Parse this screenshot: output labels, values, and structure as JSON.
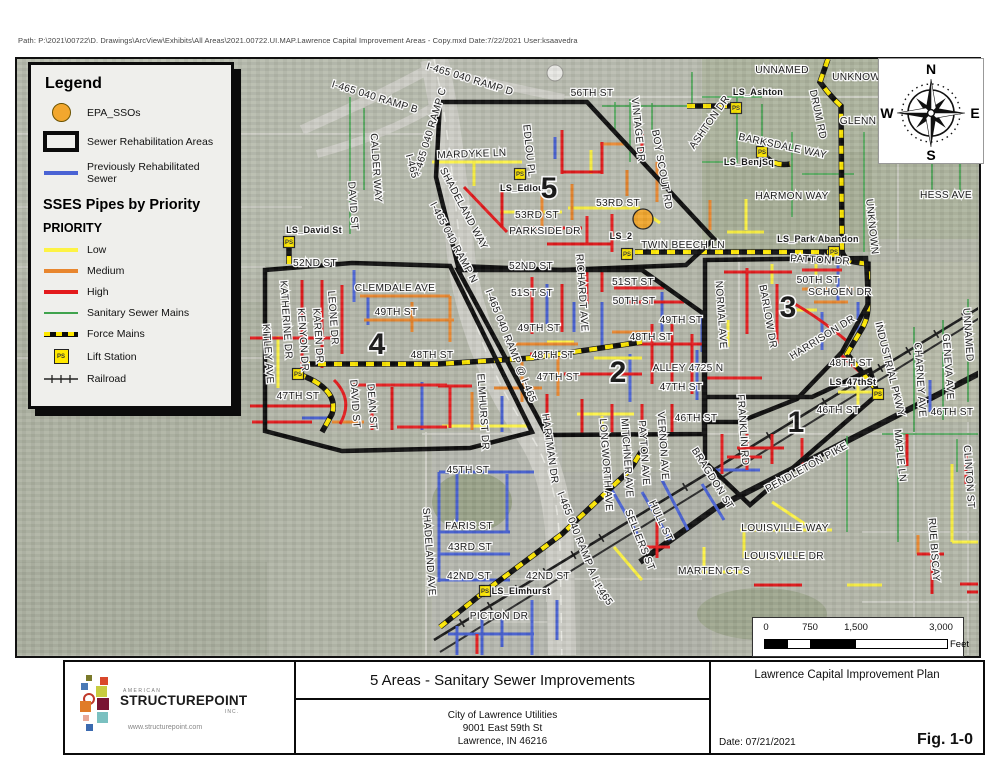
{
  "page": {
    "path_text": "Path: P:\\2021\\00722\\D. Drawings\\ArcView\\Exhibits\\All Areas\\2021.00722.UI.MAP.Lawrence Capital Improvement Areas - Copy.mxd  Date:7/22/2021  User:ksaavedra"
  },
  "colors": {
    "low": "#fdf344",
    "medium": "#e8862e",
    "high": "#e31a1c",
    "previously_rehabilitated": "#4a63d4",
    "sanitary_main": "#3fa34d",
    "sso": "#f2a72e",
    "force_main_yellow": "#ffe800"
  },
  "legend": {
    "title": "Legend",
    "top_items": [
      {
        "label": "EPA_SSOs",
        "swatch": "sso",
        "icon": "sso-circle-icon"
      },
      {
        "label": "Sewer Rehabilitation Areas",
        "swatch": "area",
        "icon": "rehab-area-icon"
      },
      {
        "label": "Previously Rehabilitated Sewer",
        "swatch": "blue",
        "icon": "blue-line-icon"
      }
    ],
    "section_title": "SSES Pipes by Priority",
    "subsection_title": "PRIORITY",
    "priority_items": [
      {
        "label": "Low",
        "swatch": "yellow",
        "icon": "yellow-line-icon"
      },
      {
        "label": "Medium",
        "swatch": "orange",
        "icon": "orange-line-icon"
      },
      {
        "label": "High",
        "swatch": "red",
        "icon": "red-line-icon"
      },
      {
        "label": "Sanitary Sewer Mains",
        "swatch": "green",
        "icon": "green-line-icon"
      },
      {
        "label": "Force Mains",
        "swatch": "force",
        "icon": "force-main-icon"
      },
      {
        "label": "Lift Station",
        "swatch": "ps",
        "ps_text": "PS",
        "icon": "lift-station-icon"
      },
      {
        "label": "Railroad",
        "swatch": "rail",
        "icon": "railroad-icon"
      }
    ]
  },
  "compass": {
    "n": "N",
    "e": "E",
    "s": "S",
    "w": "W"
  },
  "scalebar": {
    "ticks": [
      "0",
      "750",
      "1,500",
      "3,000"
    ],
    "unit": "Feet"
  },
  "titleblock": {
    "main_title": "5 Areas - Sanitary Sewer Improvements",
    "client_lines": [
      "City of Lawrence Utilities",
      "9001 East 59th St",
      "Lawrence, IN 46216"
    ],
    "plan_title": "Lawrence Capital Improvement Plan",
    "date": "Date: 07/21/2021",
    "figure": "Fig. 1-0",
    "logo": {
      "american": "AMERICAN",
      "name": "STRUCTUREPOINT",
      "inc": "INC.",
      "url": "www.structurepoint.com",
      "squares": [
        {
          "x": 21,
          "y": 13,
          "s": 6,
          "c": "#7a7a2a"
        },
        {
          "x": 35,
          "y": 15,
          "s": 8,
          "c": "#d9472b"
        },
        {
          "x": 16,
          "y": 21,
          "s": 7,
          "c": "#4a7ab5"
        },
        {
          "x": 31,
          "y": 24,
          "s": 11,
          "c": "#c8cc3f"
        },
        {
          "x": 18,
          "y": 31,
          "s": 8,
          "c": "ring"
        },
        {
          "x": 32,
          "y": 36,
          "s": 12,
          "c": "#7a1433"
        },
        {
          "x": 15,
          "y": 39,
          "s": 11,
          "c": "#e07b28"
        },
        {
          "x": 32,
          "y": 50,
          "s": 11,
          "c": "#7ac0c0"
        },
        {
          "x": 18,
          "y": 53,
          "s": 6,
          "c": "#e8a898"
        },
        {
          "x": 21,
          "y": 62,
          "s": 7,
          "c": "#3b6ab0"
        }
      ]
    }
  },
  "map": {
    "sso_points": [
      {
        "x": 641,
        "y": 217
      }
    ],
    "lift_stations": [
      {
        "x": 287,
        "y": 240
      },
      {
        "x": 296,
        "y": 372
      },
      {
        "x": 518,
        "y": 172
      },
      {
        "x": 625,
        "y": 252
      },
      {
        "x": 734,
        "y": 106
      },
      {
        "x": 760,
        "y": 150
      },
      {
        "x": 832,
        "y": 250
      },
      {
        "x": 876,
        "y": 392
      },
      {
        "x": 483,
        "y": 589
      }
    ],
    "labels": [
      {
        "t": "I-465 040 RAMP B",
        "x": 372,
        "y": 98,
        "r": 17
      },
      {
        "t": "I-465 040 RAMP C",
        "x": 431,
        "y": 130,
        "r": -73
      },
      {
        "t": "I-465 040 RAMP D",
        "x": 467,
        "y": 80,
        "r": 17
      },
      {
        "t": "56TH ST",
        "x": 590,
        "y": 94,
        "r": 0
      },
      {
        "t": "UNNAMED",
        "x": 780,
        "y": 71,
        "r": 0
      },
      {
        "t": "UNKNOWN",
        "x": 858,
        "y": 78,
        "r": 0
      },
      {
        "t": "LS_Ashton",
        "x": 756,
        "y": 93,
        "r": 0,
        "c": "ls"
      },
      {
        "t": "ASHTON DR",
        "x": 710,
        "y": 122,
        "r": -55
      },
      {
        "t": "DRUM RD",
        "x": 813,
        "y": 113,
        "r": 78
      },
      {
        "t": "GLENN",
        "x": 856,
        "y": 122,
        "r": 0
      },
      {
        "t": "BARKSDALE WAY",
        "x": 780,
        "y": 147,
        "r": 12
      },
      {
        "t": "LS_BenjSq",
        "x": 747,
        "y": 163,
        "r": 0,
        "c": "ls"
      },
      {
        "t": "HARMON WAY",
        "x": 790,
        "y": 197,
        "r": 0
      },
      {
        "t": "HESS AVE",
        "x": 944,
        "y": 196,
        "r": 0
      },
      {
        "t": "UNKNOWN",
        "x": 867,
        "y": 225,
        "r": 84
      },
      {
        "t": "LS_Park Abandon",
        "x": 816,
        "y": 240,
        "r": 0,
        "c": "ls"
      },
      {
        "t": "MARDYKE LN",
        "x": 470,
        "y": 155,
        "r": -2
      },
      {
        "t": "EDLOU PL",
        "x": 524,
        "y": 149,
        "r": 84
      },
      {
        "t": "LS_Edlou",
        "x": 520,
        "y": 189,
        "r": 0,
        "c": "ls"
      },
      {
        "t": "5",
        "x": 547,
        "y": 196,
        "r": 0,
        "c": "area"
      },
      {
        "t": "53RD ST",
        "x": 616,
        "y": 204,
        "r": 0
      },
      {
        "t": "53RD ST",
        "x": 535,
        "y": 216,
        "r": 0
      },
      {
        "t": "PARKSIDE DR",
        "x": 543,
        "y": 232,
        "r": 0
      },
      {
        "t": "LS_2",
        "x": 619,
        "y": 237,
        "r": 0,
        "c": "ls"
      },
      {
        "t": "TWIN BEECH LN",
        "x": 681,
        "y": 246,
        "r": 0
      },
      {
        "t": "VINTAGE DR",
        "x": 633,
        "y": 128,
        "r": 84
      },
      {
        "t": "BOY SCOUT RD",
        "x": 657,
        "y": 168,
        "r": 80
      },
      {
        "t": "CALDER WAY",
        "x": 371,
        "y": 166,
        "r": 86
      },
      {
        "t": "DAVID ST",
        "x": 348,
        "y": 204,
        "r": 86
      },
      {
        "t": "LS_David St",
        "x": 312,
        "y": 231,
        "r": 0,
        "c": "ls"
      },
      {
        "t": "52ND ST",
        "x": 313,
        "y": 264,
        "r": 0
      },
      {
        "t": "52ND ST",
        "x": 529,
        "y": 267,
        "r": 0
      },
      {
        "t": "SHADELAND WAY",
        "x": 459,
        "y": 208,
        "r": 62
      },
      {
        "t": "I-465",
        "x": 407,
        "y": 165,
        "r": 75
      },
      {
        "t": "I-465 040 RAMP N",
        "x": 449,
        "y": 242,
        "r": 62
      },
      {
        "t": "I-465 040 RAMP @ I-465",
        "x": 506,
        "y": 345,
        "r": 68
      },
      {
        "t": "I-465 040 RAMP A  I-465",
        "x": 577,
        "y": 545,
        "r": 68
      },
      {
        "t": "I-465",
        "x": 599,
        "y": 594,
        "r": 55
      },
      {
        "t": "CLEMDALE AVE",
        "x": 393,
        "y": 289,
        "r": 0
      },
      {
        "t": "49TH ST",
        "x": 394,
        "y": 313,
        "r": 0
      },
      {
        "t": "KITLEY AVE",
        "x": 263,
        "y": 352,
        "r": 86
      },
      {
        "t": "KATHERINE DR",
        "x": 281,
        "y": 318,
        "r": 86
      },
      {
        "t": "KENYON DR",
        "x": 298,
        "y": 338,
        "r": 86
      },
      {
        "t": "KAREN DR",
        "x": 313,
        "y": 334,
        "r": 86
      },
      {
        "t": "LEONE DR",
        "x": 328,
        "y": 316,
        "r": 86
      },
      {
        "t": "4",
        "x": 375,
        "y": 352,
        "r": 0,
        "c": "area"
      },
      {
        "t": "48TH ST",
        "x": 430,
        "y": 356,
        "r": 0
      },
      {
        "t": "48TH ST",
        "x": 551,
        "y": 356,
        "r": 0
      },
      {
        "t": "48TH ST",
        "x": 649,
        "y": 338,
        "r": 0
      },
      {
        "t": "48TH ST",
        "x": 849,
        "y": 364,
        "r": 0
      },
      {
        "t": "47TH ST",
        "x": 296,
        "y": 397,
        "r": 0
      },
      {
        "t": "47TH ST",
        "x": 556,
        "y": 378,
        "r": 0
      },
      {
        "t": "47TH ST",
        "x": 679,
        "y": 388,
        "r": 0
      },
      {
        "t": "ALLEY 4725 N",
        "x": 686,
        "y": 369,
        "r": 0
      },
      {
        "t": "DAVID ST",
        "x": 350,
        "y": 402,
        "r": 86
      },
      {
        "t": "DEAN ST",
        "x": 367,
        "y": 405,
        "r": 86
      },
      {
        "t": "2",
        "x": 616,
        "y": 380,
        "r": 0,
        "c": "area"
      },
      {
        "t": "51ST ST",
        "x": 530,
        "y": 294,
        "r": 0
      },
      {
        "t": "51ST ST",
        "x": 631,
        "y": 283,
        "r": 0
      },
      {
        "t": "50TH ST",
        "x": 632,
        "y": 302,
        "r": 0
      },
      {
        "t": "49TH ST",
        "x": 537,
        "y": 329,
        "r": 0
      },
      {
        "t": "49TH ST",
        "x": 679,
        "y": 321,
        "r": 0
      },
      {
        "t": "RICHARDT AVE",
        "x": 577,
        "y": 291,
        "r": 86
      },
      {
        "t": "PATTON DR",
        "x": 818,
        "y": 261,
        "r": 3
      },
      {
        "t": "50TH ST",
        "x": 816,
        "y": 281,
        "r": 0
      },
      {
        "t": "SCHOEN DR",
        "x": 838,
        "y": 293,
        "r": 0
      },
      {
        "t": "NORMAL AVE",
        "x": 716,
        "y": 313,
        "r": 86
      },
      {
        "t": "BARLOW DR",
        "x": 763,
        "y": 315,
        "r": 80
      },
      {
        "t": "3",
        "x": 786,
        "y": 315,
        "r": 0,
        "c": "area"
      },
      {
        "t": "HARRISON DR",
        "x": 822,
        "y": 338,
        "r": -32
      },
      {
        "t": "LS_47thSt",
        "x": 851,
        "y": 383,
        "r": 0,
        "c": "ls"
      },
      {
        "t": "1",
        "x": 794,
        "y": 430,
        "r": 0,
        "c": "area"
      },
      {
        "t": "FRANKLIN RD",
        "x": 738,
        "y": 428,
        "r": 86
      },
      {
        "t": "INDUSTRIAL PKWY",
        "x": 885,
        "y": 368,
        "r": 76
      },
      {
        "t": "CHARNEY AVE",
        "x": 915,
        "y": 378,
        "r": 86
      },
      {
        "t": "GENEVA AVE",
        "x": 943,
        "y": 365,
        "r": 86
      },
      {
        "t": "UNNAMED",
        "x": 963,
        "y": 333,
        "r": 86
      },
      {
        "t": "46TH ST",
        "x": 950,
        "y": 413,
        "r": 0
      },
      {
        "t": "46TH ST",
        "x": 836,
        "y": 411,
        "r": 0
      },
      {
        "t": "46TH ST",
        "x": 694,
        "y": 419,
        "r": 0
      },
      {
        "t": "MAPLE LN",
        "x": 895,
        "y": 454,
        "r": 84
      },
      {
        "t": "CLINTON ST",
        "x": 964,
        "y": 475,
        "r": 86
      },
      {
        "t": "RUE BISCAY",
        "x": 929,
        "y": 548,
        "r": 86
      },
      {
        "t": "PENDLETON PIKE",
        "x": 806,
        "y": 468,
        "r": -29
      },
      {
        "t": "BRAGDON ST",
        "x": 708,
        "y": 478,
        "r": 58
      },
      {
        "t": "LOUISVILLE WAY",
        "x": 783,
        "y": 529,
        "r": 0
      },
      {
        "t": "LOUISVILLE DR",
        "x": 782,
        "y": 557,
        "r": 0
      },
      {
        "t": "MARTEN CT S",
        "x": 712,
        "y": 572,
        "r": 0
      },
      {
        "t": "SELLERS ST",
        "x": 635,
        "y": 539,
        "r": 68
      },
      {
        "t": "HULL ST",
        "x": 656,
        "y": 520,
        "r": 65
      },
      {
        "t": "LONGWORTH AVE",
        "x": 601,
        "y": 463,
        "r": 86
      },
      {
        "t": "MITCHNER AVE",
        "x": 622,
        "y": 456,
        "r": 86
      },
      {
        "t": "PAYTON AVE",
        "x": 639,
        "y": 451,
        "r": 86
      },
      {
        "t": "VERNON AVE",
        "x": 658,
        "y": 444,
        "r": 86
      },
      {
        "t": "ELMHURST DR",
        "x": 478,
        "y": 410,
        "r": 86
      },
      {
        "t": "SHADELAND AVE",
        "x": 424,
        "y": 550,
        "r": 86
      },
      {
        "t": "HARTMAN DR",
        "x": 545,
        "y": 447,
        "r": 82
      },
      {
        "t": "45TH ST",
        "x": 466,
        "y": 471,
        "r": 0
      },
      {
        "t": "FARIS ST",
        "x": 467,
        "y": 527,
        "r": 0
      },
      {
        "t": "43RD ST",
        "x": 468,
        "y": 548,
        "r": 0
      },
      {
        "t": "42ND ST",
        "x": 467,
        "y": 577,
        "r": 0
      },
      {
        "t": "42ND ST",
        "x": 546,
        "y": 577,
        "r": 0
      },
      {
        "t": "LS_Elmhurst",
        "x": 519,
        "y": 592,
        "r": 0,
        "c": "ls"
      },
      {
        "t": "PICTON DR",
        "x": 497,
        "y": 617,
        "r": 0
      }
    ]
  }
}
